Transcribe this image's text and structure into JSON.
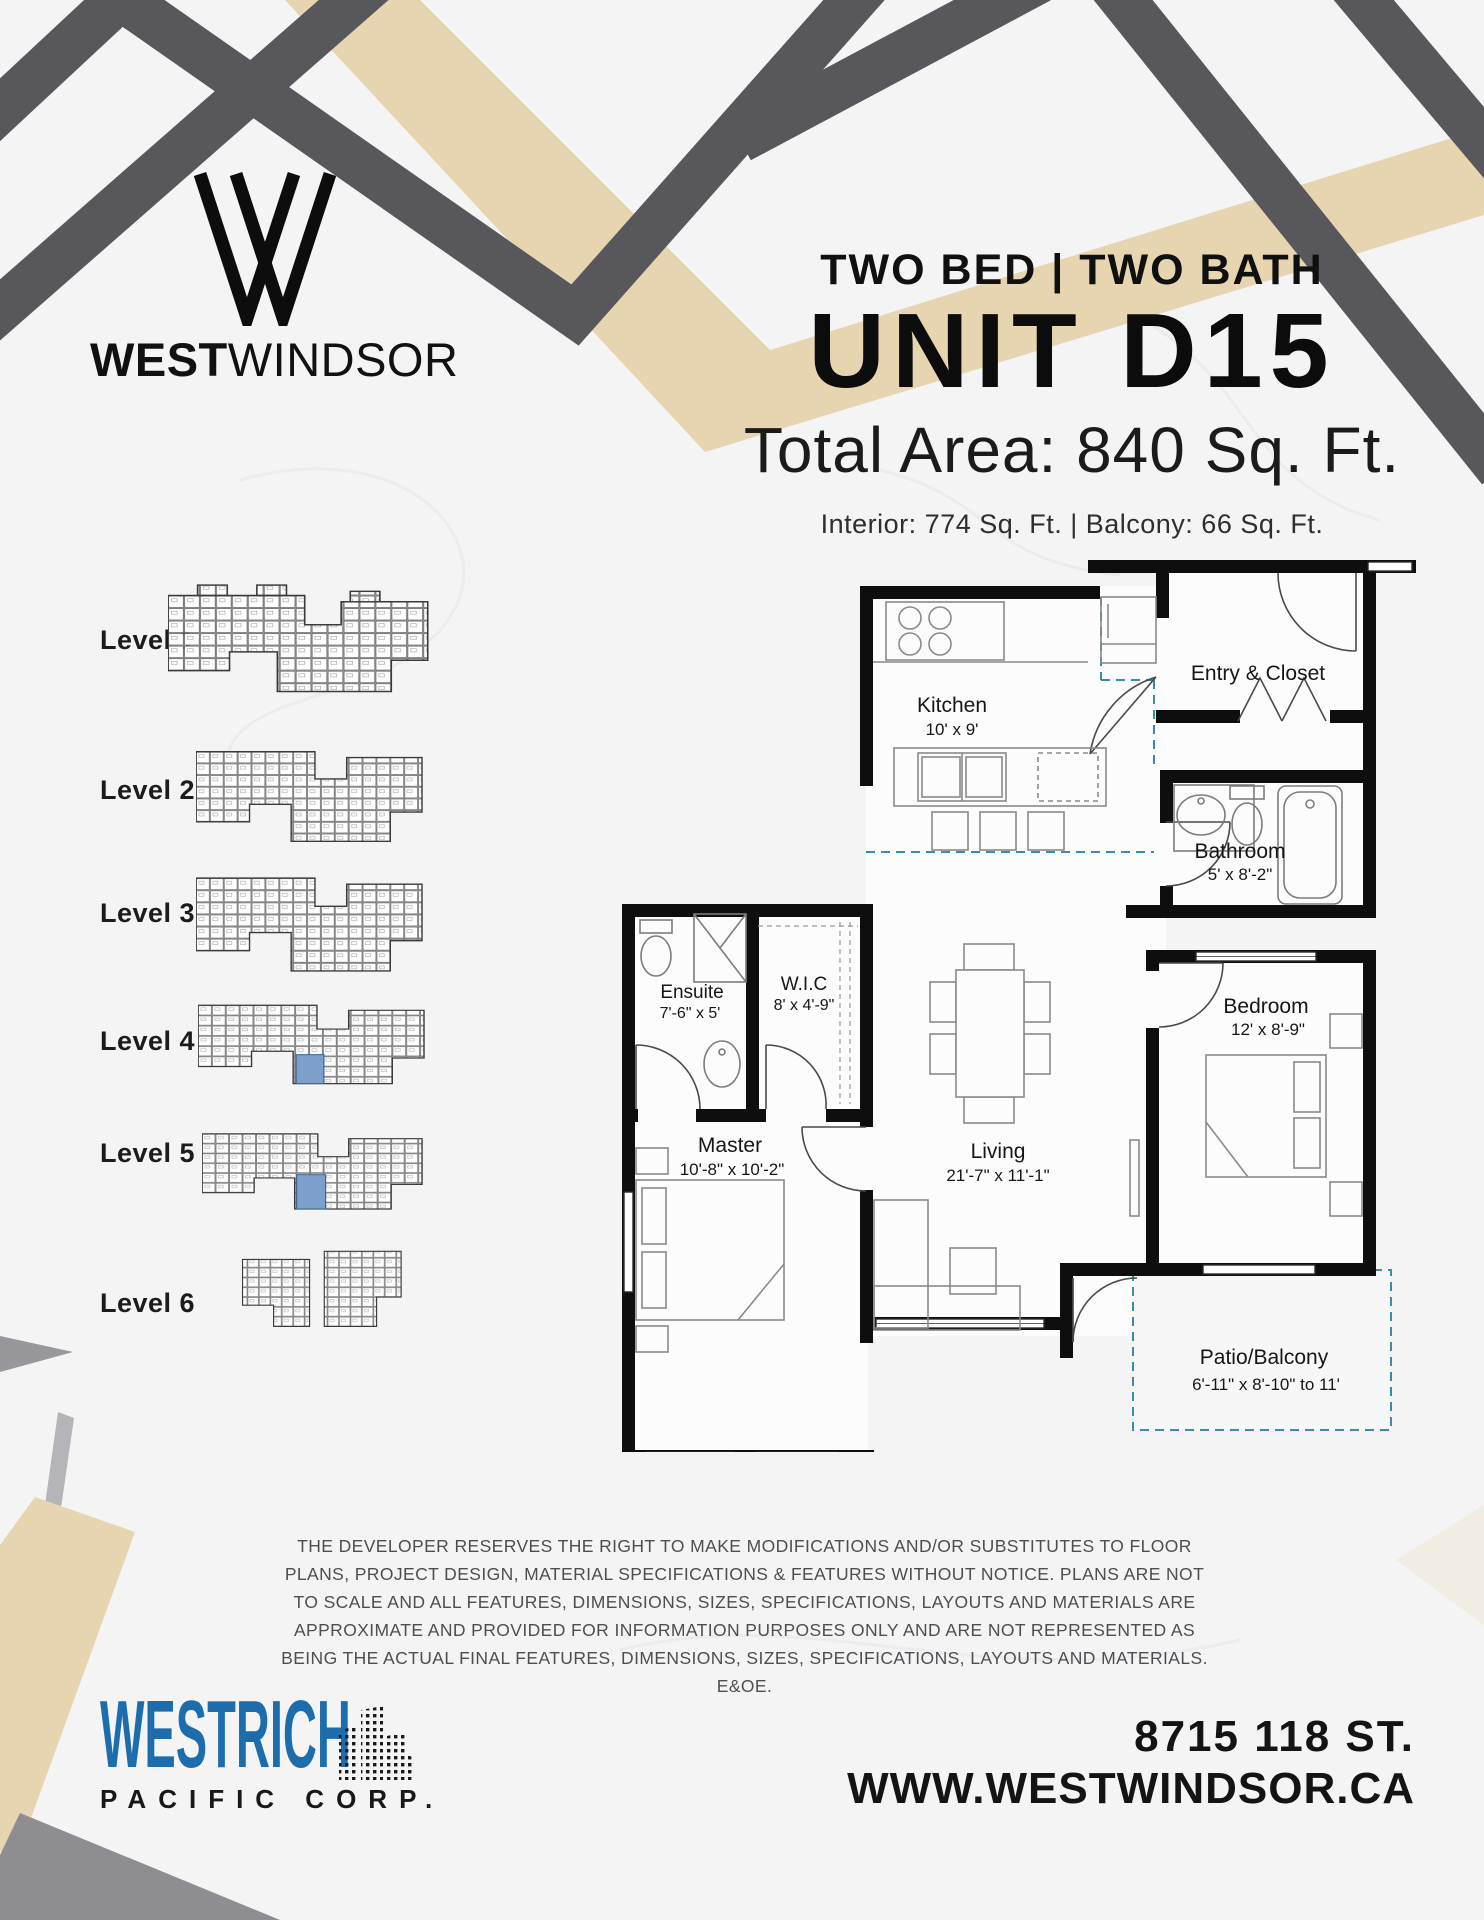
{
  "page": {
    "background": "#f4f4f5"
  },
  "colors": {
    "accent_blue": "#1d6dad",
    "deco_beige": "#e7d5b1",
    "deco_dark_gray": "#58585c",
    "deco_light_gray": "#8e8e92",
    "unit_highlight": "#7d9fca",
    "plan_dash_blue": "#3a8cab"
  },
  "brand": {
    "wordmark_bold": "WEST",
    "wordmark_light": "WINDSOR"
  },
  "header": {
    "subtitle": "TWO BED | TWO BATH",
    "title": "UNIT D15",
    "total_area": "Total Area: 840 Sq. Ft.",
    "interior_balcony": "Interior: 774 Sq. Ft. | Balcony: 66 Sq. Ft."
  },
  "levels": {
    "items": [
      {
        "label": "Level 1",
        "highlighted": false
      },
      {
        "label": "Level 2",
        "highlighted": false
      },
      {
        "label": "Level 3",
        "highlighted": false
      },
      {
        "label": "Level 4",
        "highlighted": true
      },
      {
        "label": "Level 5",
        "highlighted": true
      },
      {
        "label": "Level 6",
        "highlighted": false
      }
    ]
  },
  "floorplan": {
    "rooms": {
      "kitchen": {
        "name": "Kitchen",
        "dims": "10' x 9'"
      },
      "entry": {
        "name": "Entry & Closet",
        "dims": ""
      },
      "bathroom": {
        "name": "Bathroom",
        "dims": "5' x 8'-2\""
      },
      "ensuite": {
        "name": "Ensuite",
        "dims": "7'-6\" x 5'"
      },
      "wic": {
        "name": "W.I.C",
        "dims": "8' x 4'-9\""
      },
      "master": {
        "name": "Master",
        "dims": "10'-8\" x 10'-2\""
      },
      "living": {
        "name": "Living",
        "dims": "21'-7\" x 11'-1\""
      },
      "bedroom": {
        "name": "Bedroom",
        "dims": "12' x 8'-9\""
      },
      "patio": {
        "name": "Patio/Balcony",
        "dims": "6'-11\" x 8'-10\" to 11'"
      }
    }
  },
  "disclaimer": {
    "text": "THE DEVELOPER RESERVES THE RIGHT TO MAKE MODIFICATIONS AND/OR SUBSTITUTES TO FLOOR PLANS, PROJECT DESIGN, MATERIAL SPECIFICATIONS & FEATURES WITHOUT NOTICE. PLANS ARE NOT TO SCALE AND ALL FEATURES, DIMENSIONS, SIZES, SPECIFICATIONS, LAYOUTS AND MATERIALS ARE APPROXIMATE AND PROVIDED FOR INFORMATION PURPOSES ONLY AND ARE NOT REPRESENTED AS BEING THE ACTUAL FINAL FEATURES, DIMENSIONS, SIZES, SPECIFICATIONS, LAYOUTS AND MATERIALS. E&OE."
  },
  "footer": {
    "company": "WESTRICH",
    "company_sub": "PACIFIC CORP.",
    "address": "8715 118 ST.",
    "website": "WWW.WESTWINDSOR.CA"
  }
}
